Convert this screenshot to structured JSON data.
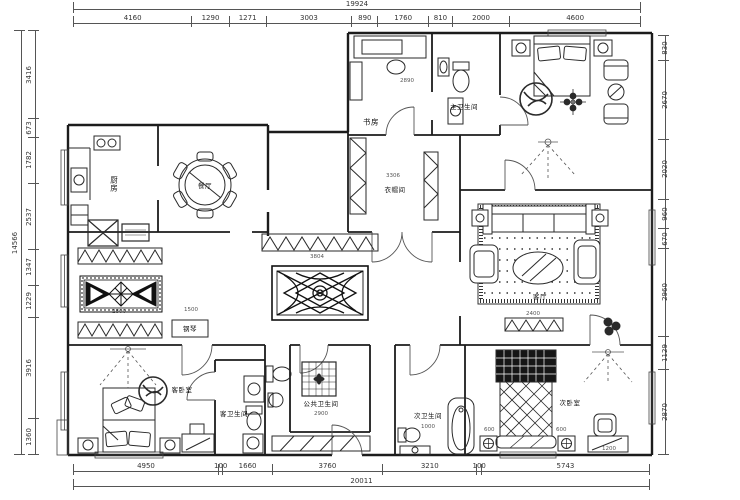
{
  "plan": {
    "title": "residential floor plan",
    "dimensions": {
      "top": {
        "total": [
          "19924"
        ],
        "segments": [
          "4160",
          "1290",
          "1271",
          "3003",
          "890",
          "1760",
          "810",
          "2000",
          "4600"
        ]
      },
      "bottom": {
        "total": [
          "20011"
        ],
        "segments": [
          "4950",
          "100",
          "1660",
          "3760",
          "3210",
          "100",
          "5743"
        ]
      },
      "left": {
        "total": [
          "14566"
        ],
        "segments": [
          "3416",
          "673",
          "1782",
          "2537",
          "1347",
          "1229",
          "3916",
          "1360"
        ]
      },
      "right": {
        "segments": [
          "830",
          "2670",
          "2020",
          "960",
          "670",
          "2960",
          "1129",
          "2870"
        ]
      }
    },
    "rooms": [
      {
        "id": "study",
        "label": "书房"
      },
      {
        "id": "master-bath",
        "label": "主卫生间"
      },
      {
        "id": "kitchen",
        "label": "厨房"
      },
      {
        "id": "dining",
        "label": "餐厅"
      },
      {
        "id": "cloakroom",
        "label": "衣帽间"
      },
      {
        "id": "living",
        "label": "客厅"
      },
      {
        "id": "piano",
        "label": "钢琴"
      },
      {
        "id": "guest-bedroom",
        "label": "客卧室"
      },
      {
        "id": "guest-bath",
        "label": "客卫生间"
      },
      {
        "id": "public-bath",
        "label": "公共卫生间"
      },
      {
        "id": "second-bath",
        "label": "次卫生间"
      },
      {
        "id": "second-bedroom",
        "label": "次卧室"
      }
    ],
    "interior_dims": [
      {
        "t": "2890",
        "x": 400,
        "y": 78
      },
      {
        "t": "3306",
        "x": 386,
        "y": 173
      },
      {
        "t": "3804",
        "x": 310,
        "y": 254
      },
      {
        "t": "2800",
        "x": 112,
        "y": 309
      },
      {
        "t": "1500",
        "x": 184,
        "y": 307
      },
      {
        "t": "2400",
        "x": 526,
        "y": 311
      },
      {
        "t": "2900",
        "x": 314,
        "y": 411
      },
      {
        "t": "1000",
        "x": 421,
        "y": 424
      },
      {
        "t": "600",
        "x": 484,
        "y": 427
      },
      {
        "t": "600",
        "x": 556,
        "y": 427
      },
      {
        "t": "1200",
        "x": 602,
        "y": 446
      }
    ],
    "line_colors": {
      "walls": "#1c1c1c",
      "furniture": "#2a2a2a",
      "dims": "#555555"
    }
  }
}
